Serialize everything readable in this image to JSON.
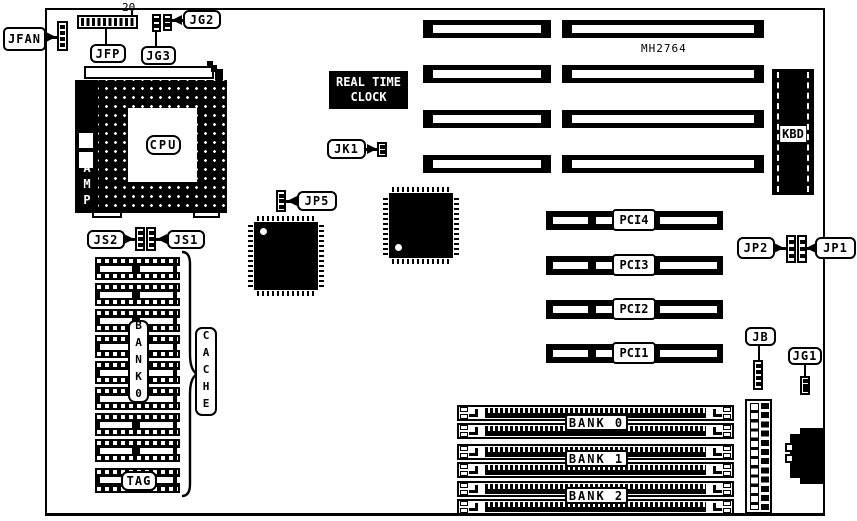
{
  "board": {
    "connector_labels": {
      "jfan": "JFAN",
      "jfp": "JFP",
      "jfp_pin_count": "20",
      "jg2": "JG2",
      "jg3": "JG3",
      "jk1": "JK1",
      "jp5": "JP5",
      "jp2": "JP2",
      "jp1": "JP1",
      "js2": "JS2",
      "js1": "JS1",
      "jb": "JB",
      "jg1": "JG1"
    },
    "chips": {
      "cpu": "CPU",
      "amp": "AMP",
      "rtc_line1": "REAL TIME",
      "rtc_line2": "CLOCK",
      "mh2764": "MH2764",
      "kbd": "KBD"
    },
    "cache": {
      "bank0_vertical": "BANK0",
      "cache_vertical": "CACHE",
      "tag": "TAG"
    },
    "pci_slots": [
      {
        "label": "PCI4"
      },
      {
        "label": "PCI3"
      },
      {
        "label": "PCI2"
      },
      {
        "label": "PCI1"
      }
    ],
    "memory_banks": [
      {
        "label": "BANK 0"
      },
      {
        "label": "BANK 1"
      },
      {
        "label": "BANK 2"
      }
    ],
    "colors": {
      "ink": "#000000",
      "paper": "#ffffff"
    }
  }
}
